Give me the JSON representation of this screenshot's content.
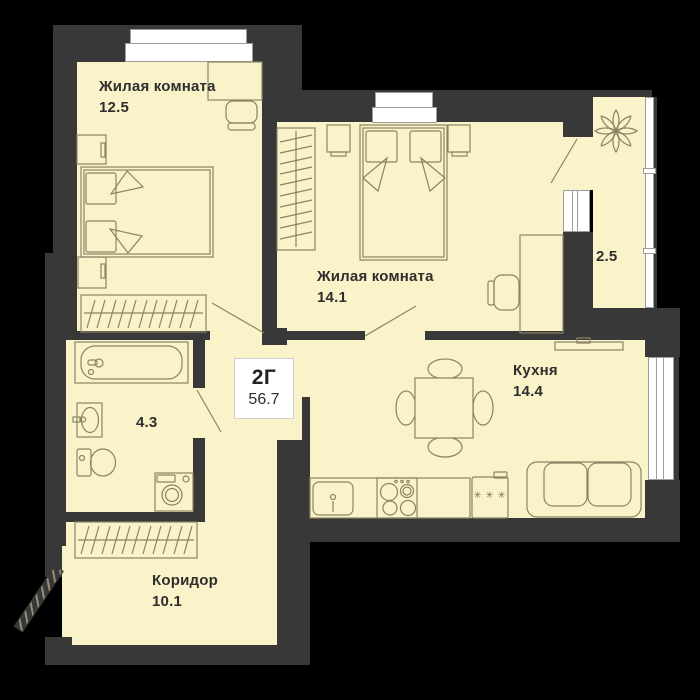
{
  "badge": {
    "plan_type": "2Г",
    "total_area": "56.7"
  },
  "rooms": {
    "living1": {
      "name": "Жилая комната",
      "area": "12.5"
    },
    "living2": {
      "name": "Жилая комната",
      "area": "14.1"
    },
    "kitchen": {
      "name": "Кухня",
      "area": "14.4"
    },
    "bathroom": {
      "area": "4.3"
    },
    "corridor": {
      "name": "Коридор",
      "area": "10.1"
    },
    "balcony": {
      "area": "2.5"
    }
  },
  "icons": {
    "freezer_marks": "✳ ✳ ✳"
  },
  "colors": {
    "background": "#000000",
    "floor": "#FAF2C8",
    "wall": "#383838",
    "furniture_stroke": "#8A8465",
    "window": "#FFFFFF",
    "text": "#2E2E2E"
  }
}
